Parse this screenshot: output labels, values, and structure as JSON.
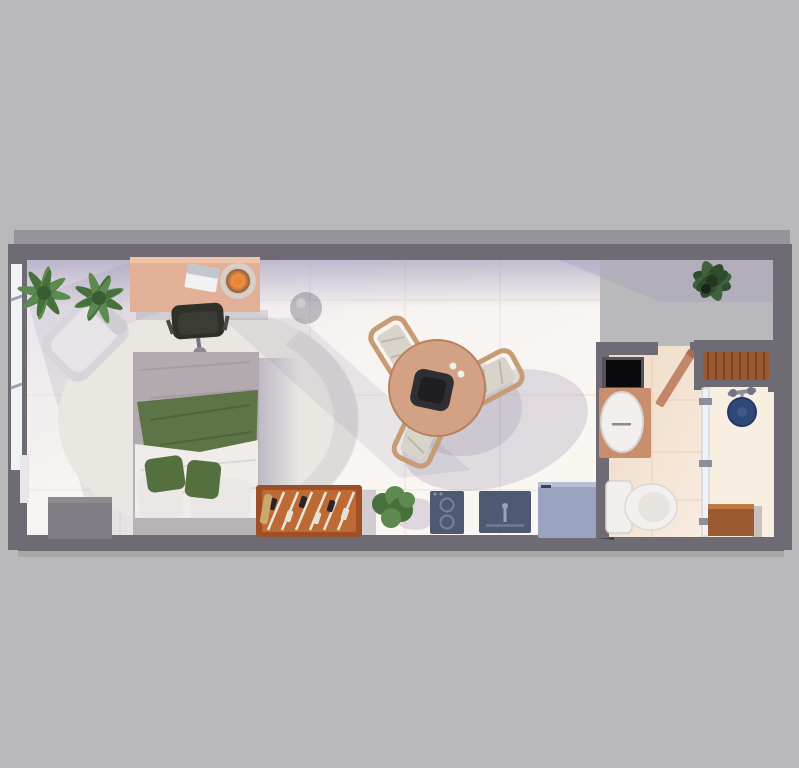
{
  "scene": {
    "view": "top-down 3D architectural render",
    "subject": "studio apartment floor plan",
    "areas": [
      {
        "name": "bedroom-living",
        "furniture": [
          "double-bed",
          "round-area-rug",
          "wood-desk",
          "office-chair",
          "laptop",
          "glowing-table-lamp",
          "lounge-chair",
          "potted-palm-left",
          "potted-palm-right",
          "side-stool"
        ]
      },
      {
        "name": "dining",
        "furniture": [
          "round-wood-dining-table",
          "dining-chair-1",
          "dining-chair-2",
          "dining-chair-3",
          "dark-serving-tray"
        ]
      },
      {
        "name": "kitchenette",
        "furniture": [
          "wood-console-foosball-table",
          "potted-shrub",
          "two-burner-cooktop",
          "sink-unit",
          "refrigerator",
          "gray-storage-cabinet"
        ]
      },
      {
        "name": "bathroom",
        "furniture": [
          "black-mirror",
          "wood-vanity-with-oval-basin",
          "toilet",
          "open-wood-door"
        ]
      },
      {
        "name": "shower-area",
        "furniture": [
          "slatted-wood-shelf",
          "navy-shower-head",
          "glass-partition",
          "wood-cabinet",
          "corner-plant-dark"
        ]
      }
    ],
    "counts": {
      "dining_chairs": 3,
      "potted_plants": 4,
      "kitchen_units": 3
    }
  },
  "palette": {
    "bg": "#b9b8ba",
    "wall": "#6e6b75",
    "wall_shadow": "#97939b",
    "floor_main": "#f7f3f0",
    "floor_bath": "#f2e2d0",
    "floor_shower": "#f8eee2",
    "rug": "#eae7e3",
    "desk_wood": "#e2b096",
    "lamp_glow": "#e8863a",
    "chair_dark": "#30302b",
    "bed_duvet": "#b2aaae",
    "blanket_green": "#5c7446",
    "bed_sheet": "#efecea",
    "pillow_green": "#55703f",
    "pillow_white": "#eae7e6",
    "bed_frame": "#b8b2b4",
    "dining_wood": "#d3a184",
    "chair_frame": "#c69c75",
    "chair_seat": "#d9d4ca",
    "console_dark": "#9e4f26",
    "console_light": "#bd6a35",
    "kitchen_navy": "#4e5a74",
    "fridge": "#9aa3c0",
    "fridge_side": "#3c4252",
    "plant_light": "#5d8a4e",
    "plant_mid": "#46703c",
    "plant_dark": "#2f4d2e",
    "porcelain": "#f2f0ee",
    "vanity_wood": "#c98e6b",
    "shower_navy": "#2f4878",
    "glass": "#eef1f5",
    "cabinet_gray": "#807d85",
    "shelf_wood": "#9c5a33",
    "window_glass": "#f0f2f5"
  }
}
